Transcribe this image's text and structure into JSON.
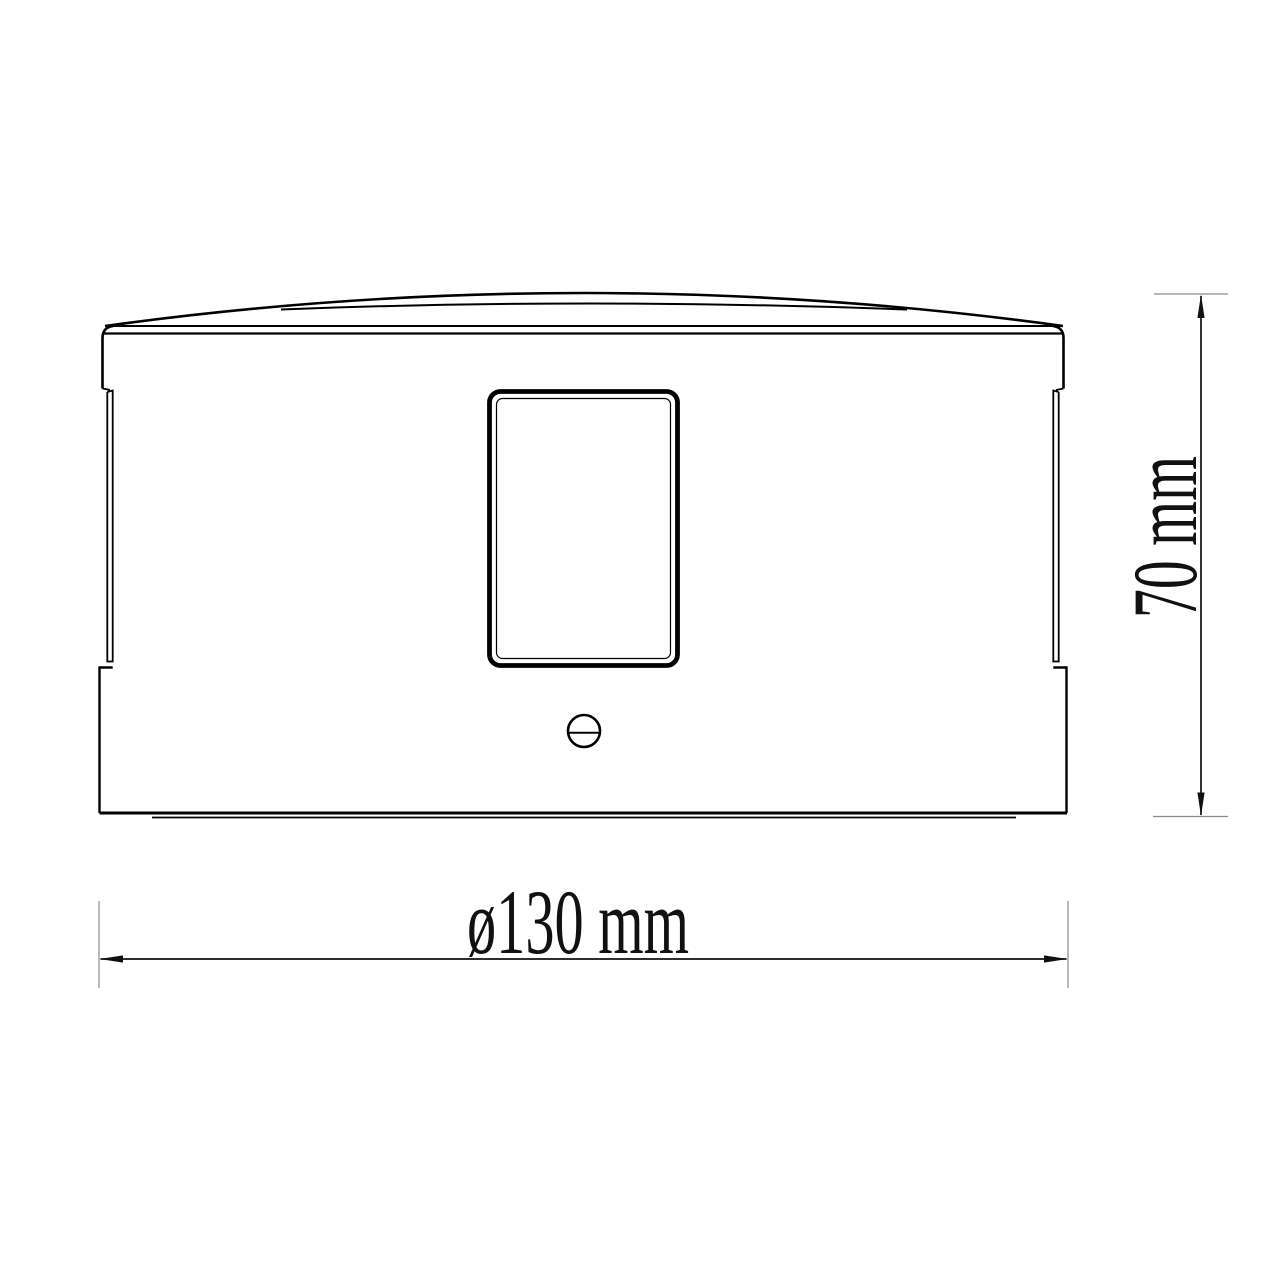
{
  "page": {
    "background": "#ffffff"
  },
  "drawing": {
    "kind": "technical-dimension-drawing",
    "view": "side-elevation",
    "dimensions": {
      "height": {
        "label": "70 mm",
        "value": "70",
        "unit": "mm",
        "orientation": "vertical"
      },
      "diameter": {
        "label": "ø130 mm",
        "value": "130",
        "unit": "mm",
        "prefix": "ø",
        "orientation": "horizontal"
      }
    },
    "colors": {
      "outline": "#000000",
      "dimension_line": "#111111",
      "extension_line": "#8c8c8c",
      "text": "#111111",
      "background": "#ffffff"
    }
  }
}
